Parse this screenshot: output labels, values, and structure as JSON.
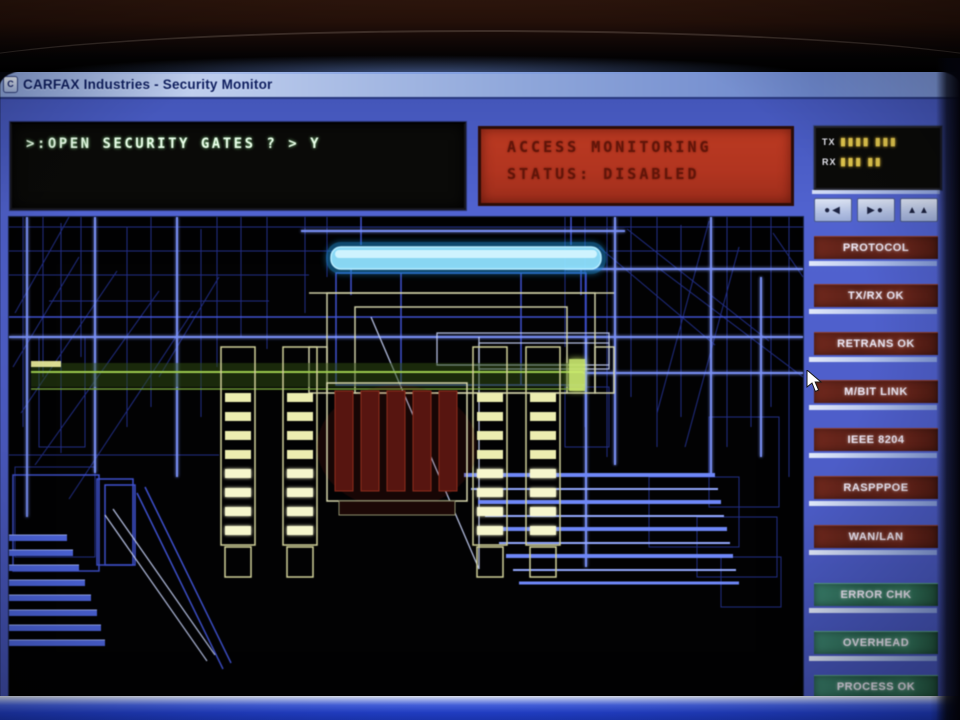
{
  "window": {
    "title": "CARFAX Industries - Security Monitor",
    "icon_glyph": "C"
  },
  "terminal": {
    "line": ">:OPEN SECURITY GATES ? > Y"
  },
  "access_status": {
    "line1": "ACCESS MONITORING",
    "line2": "STATUS: DISABLED"
  },
  "comm_panel": {
    "tx_label": "TX",
    "tx_meter": "▮▮▮▮ ▮▮▮",
    "rx_label": "RX",
    "rx_meter": "▮▮▮ ▮▮"
  },
  "comm_toolbar": {
    "buttons": [
      {
        "glyphs": "●◀"
      },
      {
        "glyphs": "▶●"
      },
      {
        "glyphs": "▲▲"
      }
    ]
  },
  "sidebar": {
    "buttons": [
      {
        "label": "PROTOCOL",
        "group": "status-red"
      },
      {
        "label": "TX/RX OK",
        "group": "status-red"
      },
      {
        "label": "RETRANS OK",
        "group": "status-red"
      },
      {
        "label": "M/BIT LINK",
        "group": "status-red"
      },
      {
        "label": "IEEE 8204",
        "group": "status-red"
      },
      {
        "label": "RASPPPOE",
        "group": "status-red"
      },
      {
        "label": "WAN/LAN",
        "group": "status-red"
      },
      {
        "label": "ERROR CHK",
        "group": "status-teal"
      },
      {
        "label": "OVERHEAD",
        "group": "status-teal"
      },
      {
        "label": "PROCESS OK",
        "group": "status-teal"
      }
    ]
  },
  "colors": {
    "desktop_blue": "#4e5ec9",
    "titlebar_text": "#0c1c5e",
    "terminal_text": "#eaffea",
    "status_box_bg": "#b23520",
    "status_box_text": "#611509",
    "button_red": "#63221a",
    "button_teal": "#2e6c59",
    "meter_yellow": "#e3c84e",
    "wireframe_blue": "#4458e0",
    "highlight_cyan": "#8fe2ff",
    "gate_yellow": "#ecedb0",
    "band_green": "#9ccb4e",
    "bottom_strip_blue": "#2443d6"
  }
}
